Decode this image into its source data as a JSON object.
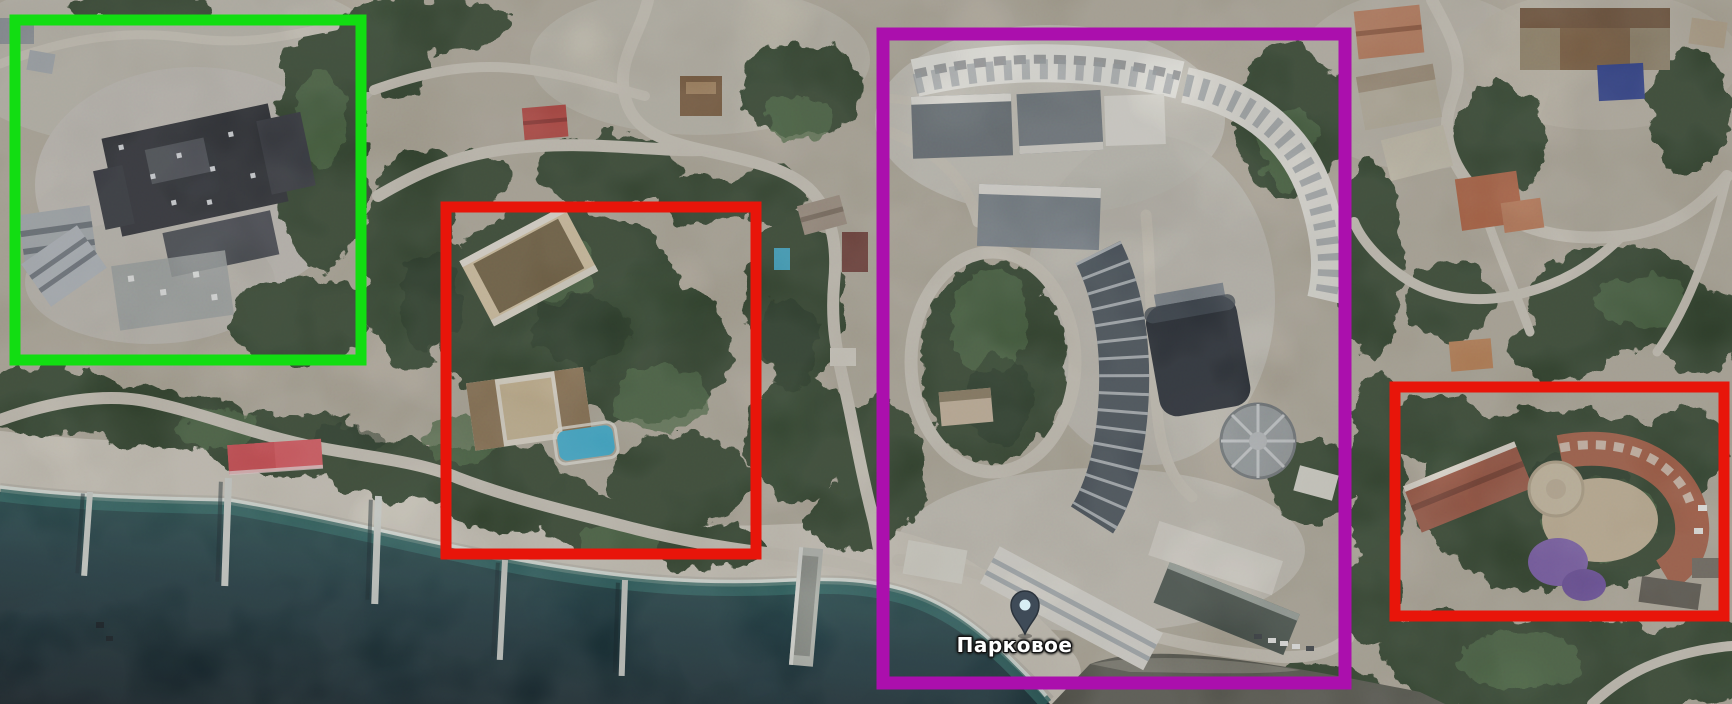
{
  "map": {
    "place_label": "Парковое",
    "pin_color": "#3f4b58",
    "pin_dot_color": "#d8eef4"
  },
  "annotations": {
    "boxes": [
      {
        "name": "green-box",
        "color": "#12dd12"
      },
      {
        "name": "red-box-left",
        "color": "#e8150a"
      },
      {
        "name": "purple-box",
        "color": "#ab0fad"
      },
      {
        "name": "red-box-right",
        "color": "#e8150a"
      }
    ]
  },
  "scene": {
    "ground_color": "#b6ae9e",
    "vegetation_color": "#2f4329",
    "road_color": "#d0cabd",
    "beach_color": "#d4cec1",
    "sea_deep_color": "#0a161d",
    "sea_mid_color": "#16333a",
    "sea_shallow_color": "#2e6a66",
    "awning_color": "#e4555c",
    "pool_color": "#3fb6da",
    "pool_small_color": "#3aa9c9",
    "villa_pool_color": "#2c3e8f",
    "canopy_color": "#7e5fae"
  }
}
